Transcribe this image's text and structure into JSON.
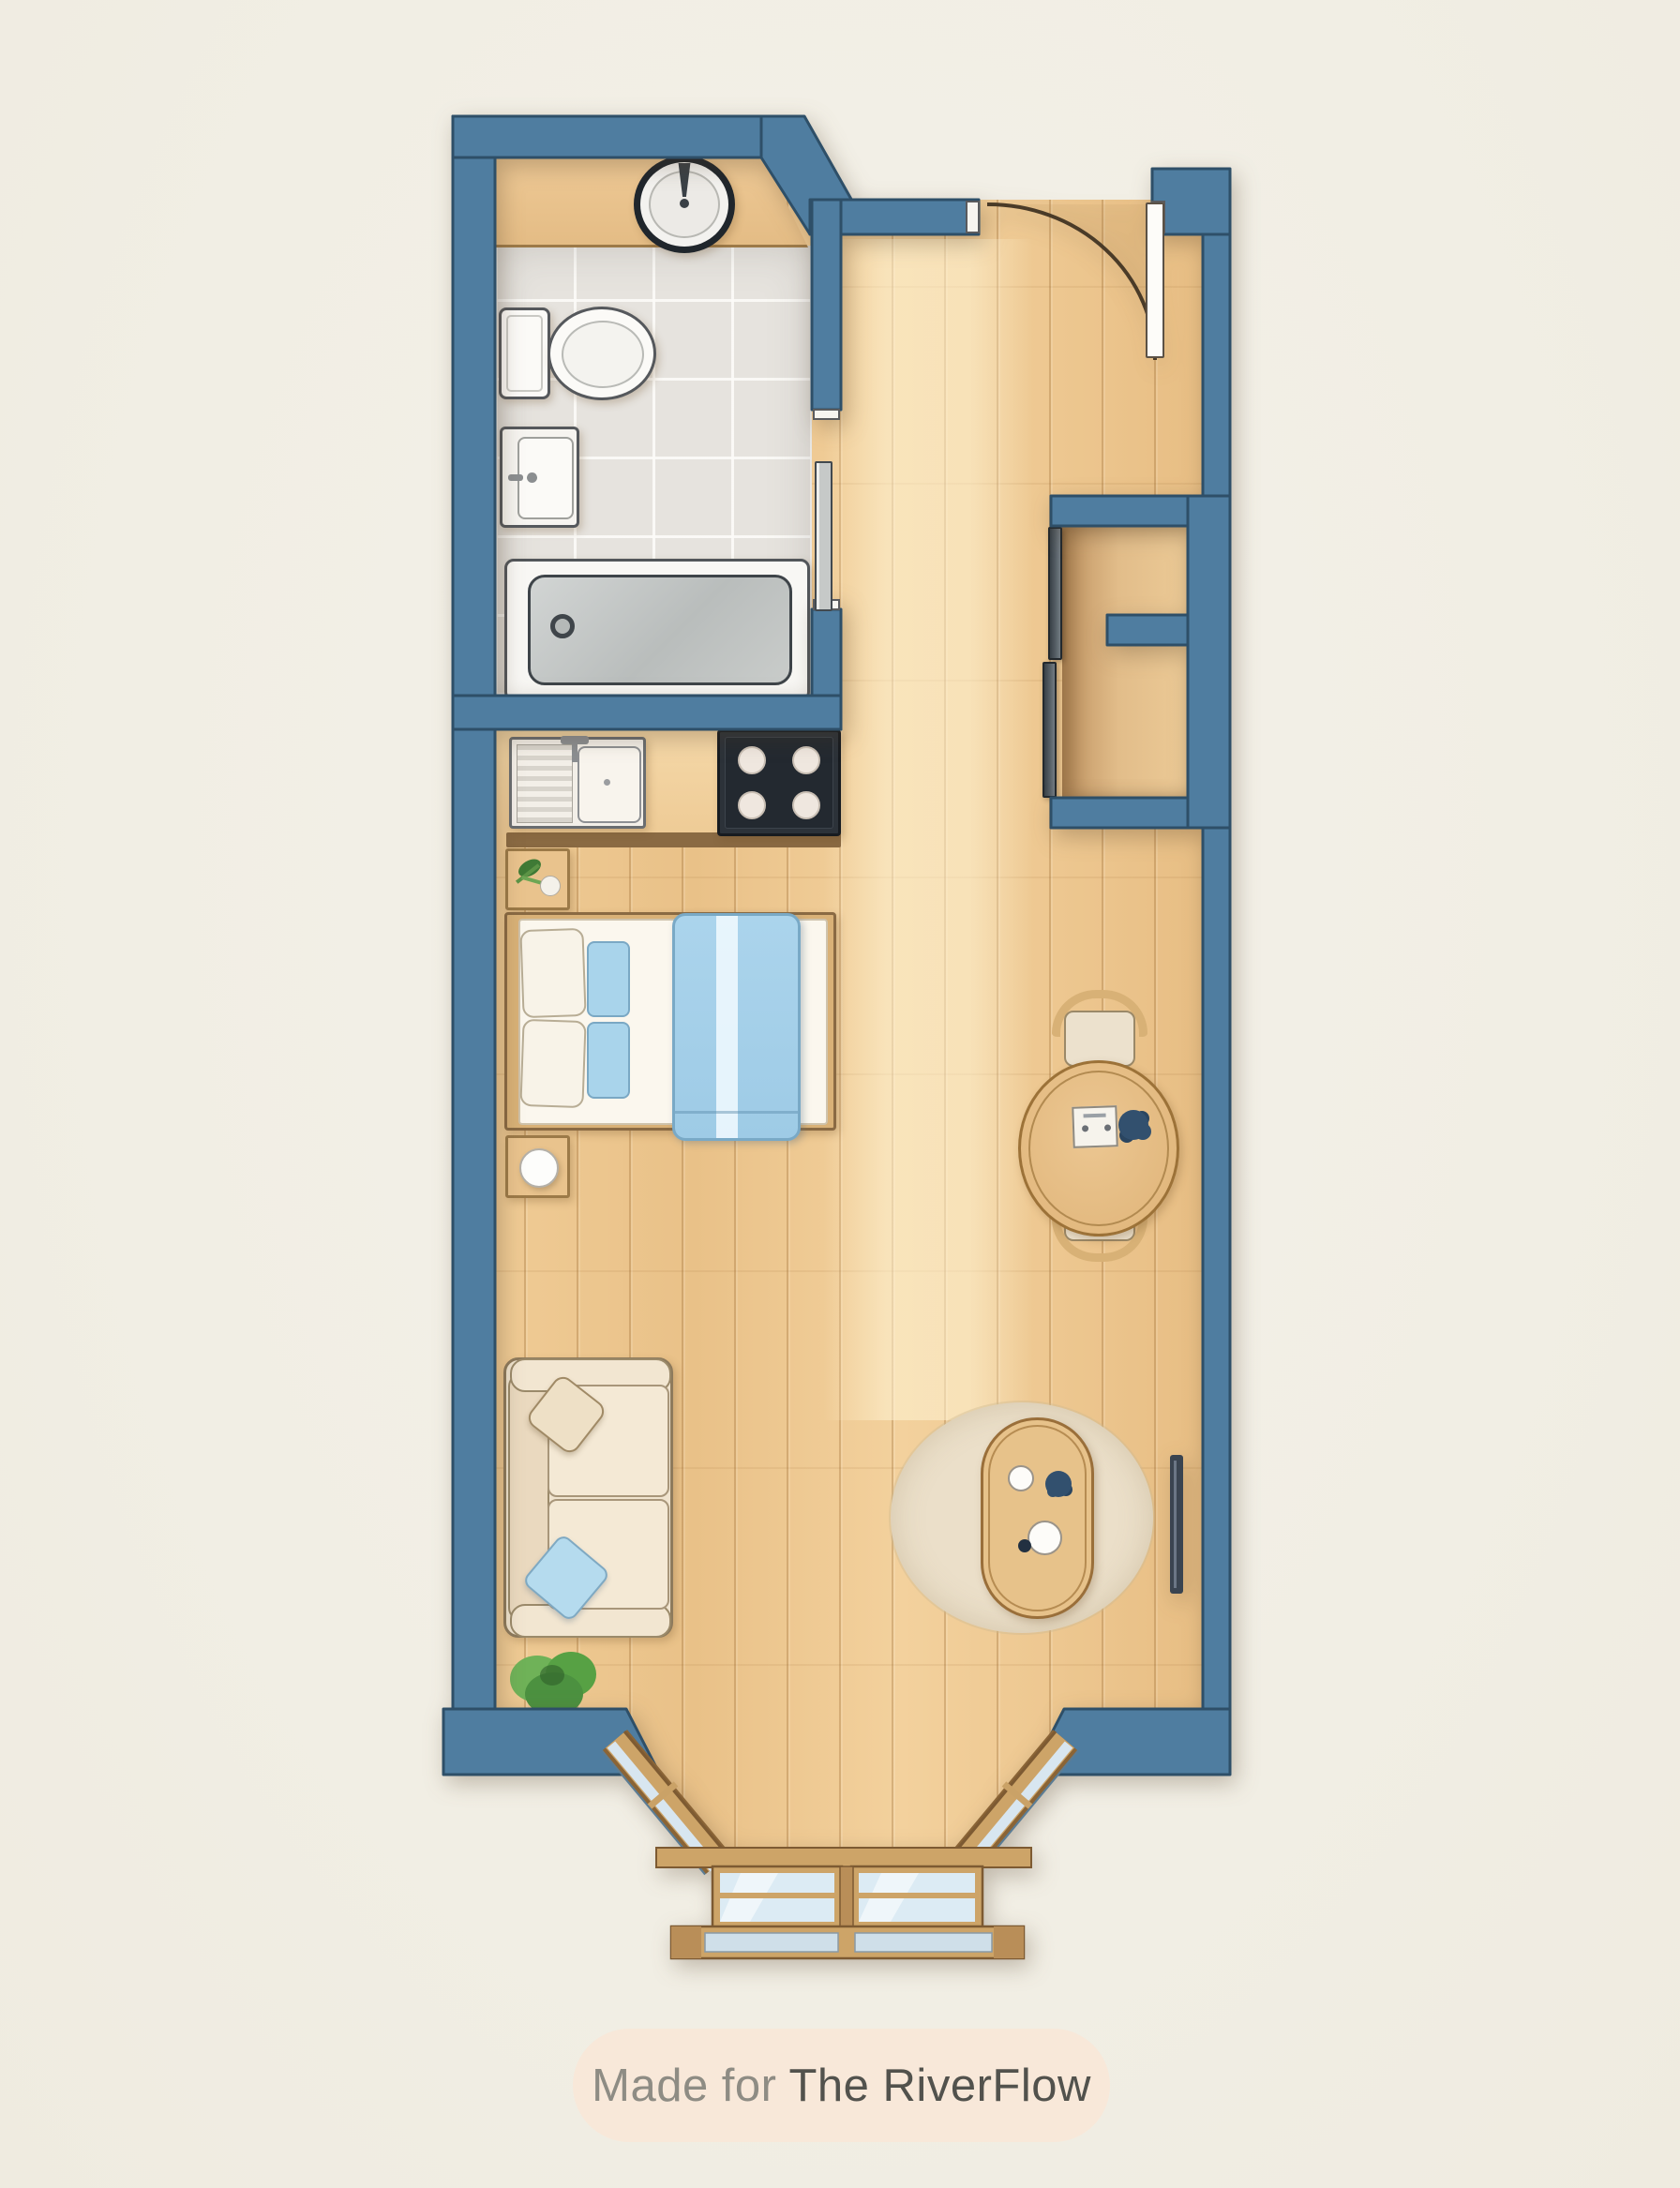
{
  "badge": {
    "prefix": "Made for",
    "brand": "The RiverFlow"
  },
  "palette": {
    "background": "#f2efe6",
    "wall_blue": "#4f7da0",
    "wall_outline": "#2e4f68",
    "floor_wood": "#edc68f",
    "bathroom_tile": "#e6e3de",
    "bed_blanket_blue": "#a5cfe9",
    "sofa_cream": "#f0e4cf",
    "rug_beige": "#ebdfc9",
    "badge_bg": "#f8e8d9",
    "badge_text_gray": "#8e8c84",
    "badge_brand_gray": "#52524d"
  },
  "rooms": [
    "bathroom",
    "kitchen",
    "sleeping-area",
    "living-area",
    "entry-hall",
    "wardrobe",
    "bay-window"
  ],
  "furniture_icons": [
    "round-basin-icon",
    "toilet-icon",
    "wall-sink-icon",
    "bathtub-icon",
    "kitchen-sink-icon",
    "stove-icon",
    "plant-sprig-icon",
    "double-bed-icon",
    "nightstand-icon",
    "table-lamp-icon",
    "wardrobe-sliding-doors-icon",
    "dining-table-icon",
    "dining-chair-icon",
    "sofa-icon",
    "throw-pillow-icon",
    "potted-plant-icon",
    "area-rug-icon",
    "coffee-table-icon",
    "radiator-icon",
    "entry-door-swing-icon",
    "bathroom-sliding-door-icon",
    "bay-window-icon"
  ]
}
